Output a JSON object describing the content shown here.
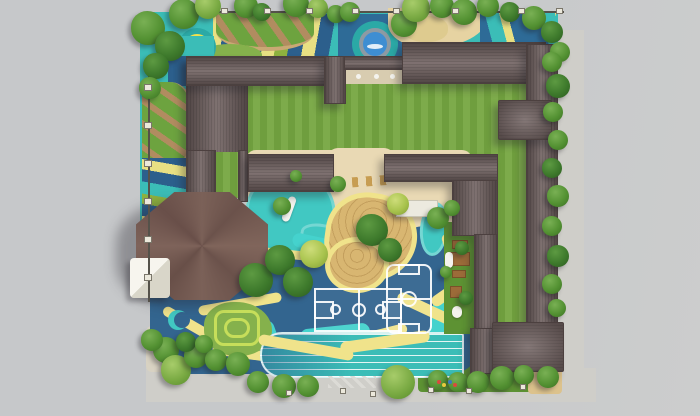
{
  "scene": {
    "type": "architectural-site-plan-rendering",
    "subject": "Top-down master plan rendering of a kindergarten campus: C-shaped building with dark hip roofs around a striped lawn courtyard, octagonal hall, playground mats, pool, sandbox, basketball court, five-a-side pitch, running track, tree-lined perimeter",
    "visible_text": ""
  },
  "palette": {
    "bg": "#c6c8ca",
    "bg_light": "#cccdcd",
    "sidewalk": "#cfcec9",
    "roof": "#6d5e5d",
    "roof_edge": "#4c403f",
    "octagon_roof": "#73584f",
    "lawn_a": "#6f9e3e",
    "lawn_b": "#7dab4b",
    "lawn_dark": "#5d9233",
    "teal": "#3bbdb7",
    "teal_deep": "#2ba9a6",
    "teal_bright": "#45d2cd",
    "pool_teal": "#41c8c2",
    "blue_mat": "#2e6b97",
    "blue_deep": "#2c5f8c",
    "court_blue": "#33658f",
    "cream": "#e9d9b4",
    "sand": "#d8b671",
    "sand_path": "#e6d3a2",
    "yellow": "#f0e38b",
    "yellow_stripe": "#e8e083",
    "green_stripe": "#8eb23f",
    "garden_green": "#6da33f",
    "path_brown": "#b18c60",
    "path_tan": "#c9a874",
    "fence": "#55524a",
    "post": "#ece9dc",
    "white": "#f4f3ee",
    "water": "#3e8ed2",
    "ring_gray": "#8d9aa3",
    "ring_yellow": "#f0e24e",
    "wood": "#9c6b39",
    "wood_dark": "#7a5128",
    "maze": "#85b14c",
    "maze_line": "#c6de5a",
    "pad": "#f1efe6",
    "terrace": "#d8ccb0",
    "tree_dark": "#3e7a2c",
    "tree_dark_hi": "#5d9a42",
    "tree_mid": "#549233",
    "tree_mid_hi": "#79b054",
    "tree_light": "#7bab44",
    "tree_light_hi": "#a7cc6a",
    "tree_bright": "#a8c34d",
    "tree_bright_hi": "#cedd7a"
  },
  "areas": [
    {
      "name": "main-building-roofs",
      "color": "#6d5e5d"
    },
    {
      "name": "octagonal-hall-roof",
      "color": "#73584f"
    },
    {
      "name": "central-lawn",
      "colors": [
        "#6f9e3e",
        "#7dab4b"
      ]
    },
    {
      "name": "blue-play-surface",
      "color": "#33658f"
    },
    {
      "name": "teal-playground-mats",
      "color": "#3bbdb7"
    },
    {
      "name": "round-pool",
      "colors": [
        "#49c5c6",
        "#8d9aa3",
        "#3e8ed2"
      ]
    },
    {
      "name": "yellow-ring-game",
      "color": "#f0e24e"
    },
    {
      "name": "sand-mound",
      "color": "#d8b671"
    },
    {
      "name": "winding-yellow-paths",
      "color": "#f0e38b"
    },
    {
      "name": "running-track",
      "color": "#3bbdb7",
      "lanes": 6
    },
    {
      "name": "basketball-court",
      "line_color": "#ffffff"
    },
    {
      "name": "five-a-side-pitch",
      "line_color": "#ffffff"
    },
    {
      "name": "garden-beds-diagonal-paths",
      "colors": [
        "#6da33f",
        "#b18c60"
      ]
    },
    {
      "name": "perimeter-trees-and-sidewalk",
      "color": "#cfcec9"
    }
  ],
  "trees": [
    {
      "x": 148,
      "y": 28,
      "d": 34,
      "v": "m"
    },
    {
      "x": 170,
      "y": 46,
      "d": 30,
      "v": "d"
    },
    {
      "x": 156,
      "y": 66,
      "d": 26,
      "v": "d"
    },
    {
      "x": 150,
      "y": 88,
      "d": 22,
      "v": "m"
    },
    {
      "x": 184,
      "y": 14,
      "d": 30,
      "v": "m"
    },
    {
      "x": 208,
      "y": 6,
      "d": 26,
      "v": "l"
    },
    {
      "x": 246,
      "y": 6,
      "d": 24,
      "v": "m"
    },
    {
      "x": 262,
      "y": 12,
      "d": 18,
      "v": "d"
    },
    {
      "x": 296,
      "y": 4,
      "d": 26,
      "v": "m"
    },
    {
      "x": 318,
      "y": 8,
      "d": 20,
      "v": "l"
    },
    {
      "x": 336,
      "y": 14,
      "d": 18,
      "v": "m"
    },
    {
      "x": 350,
      "y": 12,
      "d": 20,
      "v": "m"
    },
    {
      "x": 404,
      "y": 24,
      "d": 26,
      "v": "m"
    },
    {
      "x": 416,
      "y": 8,
      "d": 28,
      "v": "l"
    },
    {
      "x": 442,
      "y": 6,
      "d": 24,
      "v": "m"
    },
    {
      "x": 464,
      "y": 12,
      "d": 26,
      "v": "m"
    },
    {
      "x": 488,
      "y": 6,
      "d": 22,
      "v": "m"
    },
    {
      "x": 510,
      "y": 12,
      "d": 20,
      "v": "d"
    },
    {
      "x": 534,
      "y": 18,
      "d": 24,
      "v": "m"
    },
    {
      "x": 552,
      "y": 32,
      "d": 22,
      "v": "d"
    },
    {
      "x": 560,
      "y": 52,
      "d": 20,
      "v": "m"
    },
    {
      "x": 552,
      "y": 62,
      "d": 20,
      "v": "m"
    },
    {
      "x": 558,
      "y": 86,
      "d": 24,
      "v": "d"
    },
    {
      "x": 553,
      "y": 112,
      "d": 20,
      "v": "m"
    },
    {
      "x": 558,
      "y": 140,
      "d": 20,
      "v": "m"
    },
    {
      "x": 552,
      "y": 168,
      "d": 20,
      "v": "d"
    },
    {
      "x": 558,
      "y": 196,
      "d": 22,
      "v": "m"
    },
    {
      "x": 552,
      "y": 226,
      "d": 20,
      "v": "m"
    },
    {
      "x": 558,
      "y": 256,
      "d": 22,
      "v": "d"
    },
    {
      "x": 552,
      "y": 284,
      "d": 20,
      "v": "m"
    },
    {
      "x": 557,
      "y": 308,
      "d": 18,
      "v": "m"
    },
    {
      "x": 166,
      "y": 350,
      "d": 26,
      "v": "m"
    },
    {
      "x": 176,
      "y": 370,
      "d": 30,
      "v": "l"
    },
    {
      "x": 196,
      "y": 356,
      "d": 24,
      "v": "m"
    },
    {
      "x": 216,
      "y": 360,
      "d": 22,
      "v": "m"
    },
    {
      "x": 238,
      "y": 364,
      "d": 24,
      "v": "m"
    },
    {
      "x": 258,
      "y": 382,
      "d": 22,
      "v": "m"
    },
    {
      "x": 284,
      "y": 386,
      "d": 24,
      "v": "m"
    },
    {
      "x": 308,
      "y": 386,
      "d": 22,
      "v": "m"
    },
    {
      "x": 398,
      "y": 382,
      "d": 34,
      "v": "l"
    },
    {
      "x": 438,
      "y": 380,
      "d": 20,
      "v": "m"
    },
    {
      "x": 458,
      "y": 382,
      "d": 20,
      "v": "m"
    },
    {
      "x": 478,
      "y": 382,
      "d": 22,
      "v": "m"
    },
    {
      "x": 502,
      "y": 378,
      "d": 24,
      "v": "m"
    },
    {
      "x": 524,
      "y": 375,
      "d": 20,
      "v": "m"
    },
    {
      "x": 548,
      "y": 377,
      "d": 22,
      "v": "m"
    },
    {
      "x": 152,
      "y": 340,
      "d": 22,
      "v": "m"
    },
    {
      "x": 186,
      "y": 342,
      "d": 20,
      "v": "d"
    },
    {
      "x": 204,
      "y": 344,
      "d": 18,
      "v": "m"
    },
    {
      "x": 256,
      "y": 280,
      "d": 34,
      "v": "d"
    },
    {
      "x": 280,
      "y": 260,
      "d": 30,
      "v": "d"
    },
    {
      "x": 298,
      "y": 282,
      "d": 30,
      "v": "d"
    },
    {
      "x": 314,
      "y": 254,
      "d": 28,
      "v": "b"
    },
    {
      "x": 372,
      "y": 230,
      "d": 32,
      "v": "d"
    },
    {
      "x": 390,
      "y": 250,
      "d": 24,
      "v": "d"
    },
    {
      "x": 282,
      "y": 206,
      "d": 18,
      "v": "m"
    },
    {
      "x": 338,
      "y": 184,
      "d": 16,
      "v": "m"
    },
    {
      "x": 296,
      "y": 176,
      "d": 12,
      "v": "m"
    },
    {
      "x": 398,
      "y": 204,
      "d": 22,
      "v": "b"
    },
    {
      "x": 438,
      "y": 218,
      "d": 22,
      "v": "m"
    },
    {
      "x": 452,
      "y": 208,
      "d": 16,
      "v": "m"
    },
    {
      "x": 462,
      "y": 248,
      "d": 14,
      "v": "d"
    },
    {
      "x": 466,
      "y": 298,
      "d": 14,
      "v": "d"
    },
    {
      "x": 446,
      "y": 272,
      "d": 12,
      "v": "m"
    }
  ],
  "fence_posts": {
    "top_x": [
      221,
      264,
      306,
      352,
      393,
      452,
      518,
      556
    ],
    "left_y": [
      84,
      122,
      160,
      198,
      236,
      274
    ],
    "bottom": [
      [
        286,
        390
      ],
      [
        340,
        388
      ],
      [
        370,
        391
      ],
      [
        428,
        387
      ],
      [
        466,
        388
      ],
      [
        520,
        384
      ]
    ]
  },
  "play_items": [
    {
      "x": 437,
      "y": 380,
      "c": "#d94b3c"
    },
    {
      "x": 442,
      "y": 383,
      "c": "#e8c93e"
    },
    {
      "x": 448,
      "y": 380,
      "c": "#3a78c2"
    },
    {
      "x": 453,
      "y": 383,
      "c": "#d94b3c"
    }
  ]
}
